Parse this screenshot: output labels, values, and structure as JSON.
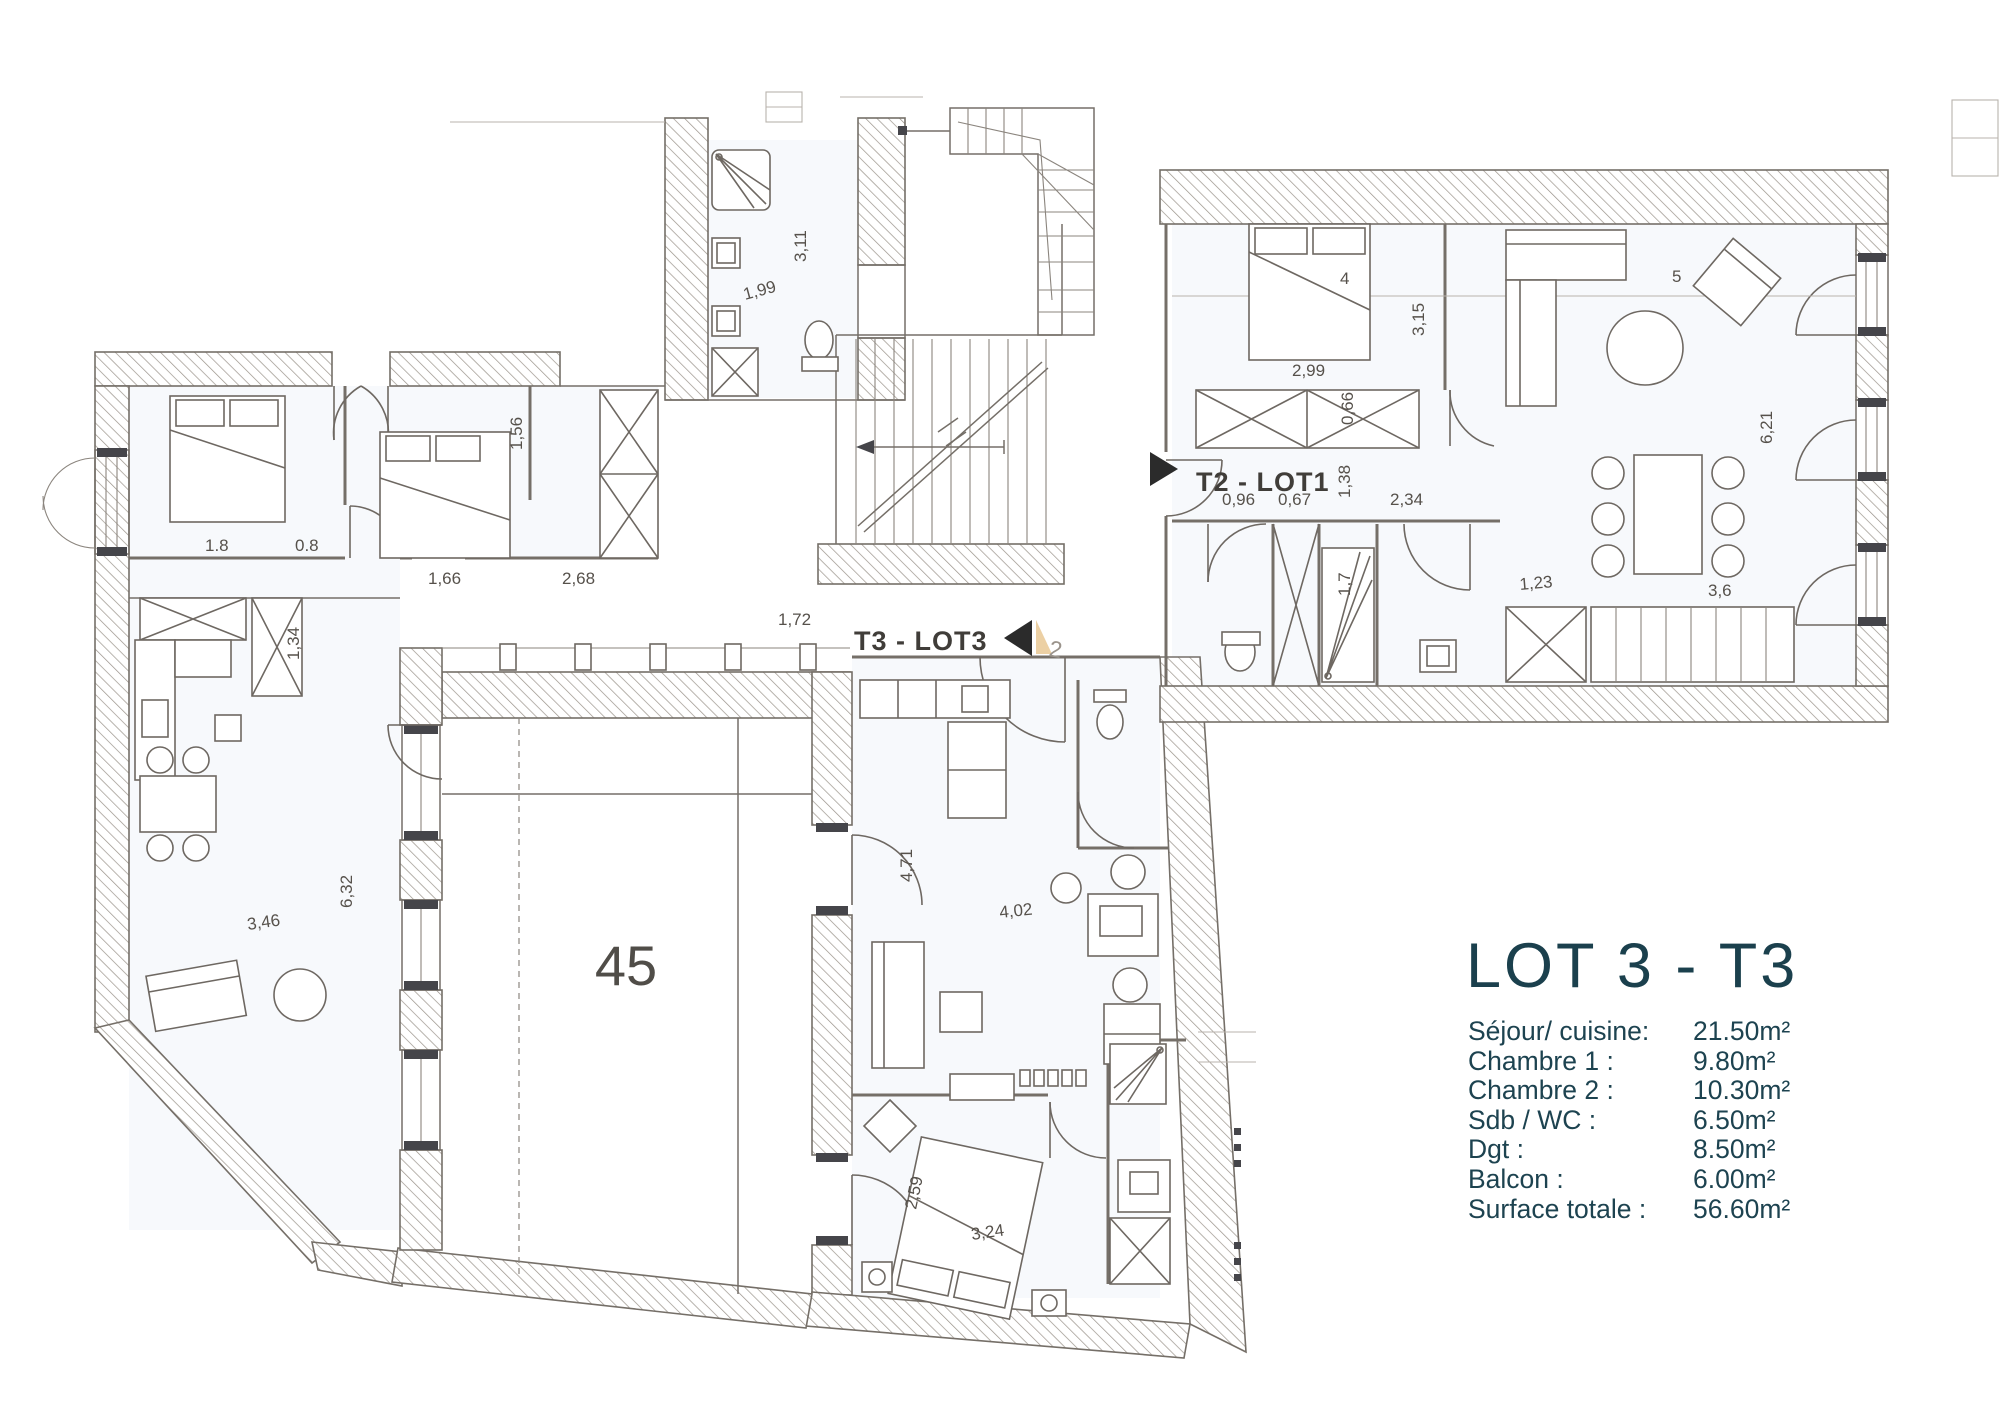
{
  "plan": {
    "unit_labels": {
      "t2_lot1": "T2 - LOT1",
      "t3_lot3": "T3 - LOT3",
      "terrace_number": "45",
      "stair_note": "2"
    },
    "dimensions": {
      "bathroom_width": "1,99",
      "bathroom_length": "3,11",
      "bedroom1_a": "1.8",
      "bedroom1_b": "0.8",
      "bedroom2_length": "1,56",
      "hall_a": "1,66",
      "hall_b": "2,68",
      "hall_c": "1,72",
      "cabinet_height": "1,34",
      "kitchen_width": "3,46",
      "kitchen_length": "6,32",
      "t3_living_length": "4,71",
      "t3_living_width": "4,02",
      "t3_bed_width": "2,59",
      "t3_bed_length": "3,24",
      "t2_dim_a": "0,96",
      "t2_dim_b": "0,67",
      "t2_dim_c": "1,38",
      "t2_dim_d": "2,34",
      "t2_bed_width": "2,99",
      "t2_bed_label": "4",
      "t2_room_length": "3,15",
      "t2_wardrobe": "0,66",
      "t2_shower": "1,7",
      "t2_hall": "1,23",
      "living_length": "6,21",
      "living_width": "3,6",
      "sofa_label": "5"
    }
  },
  "legend": {
    "title": "LOT 3 - T3",
    "rows": [
      {
        "label": "Séjour/ cuisine:",
        "value": "21.50m²"
      },
      {
        "label": "Chambre 1 :",
        "value": "9.80m²"
      },
      {
        "label": "Chambre 2 :",
        "value": "10.30m²"
      },
      {
        "label": "Sdb / WC :",
        "value": "6.50m²"
      },
      {
        "label": "Dgt :",
        "value": "8.50m²"
      },
      {
        "label": "Balcon :",
        "value": "6.00m²"
      },
      {
        "label": "Surface totale :",
        "value": "56.60m²"
      }
    ]
  },
  "colors": {
    "accent_teal": "#1b404d",
    "plan_line": "#756f68",
    "arrow_black": "#2b2b2b",
    "wedge_tan": "#ecd0a4"
  }
}
